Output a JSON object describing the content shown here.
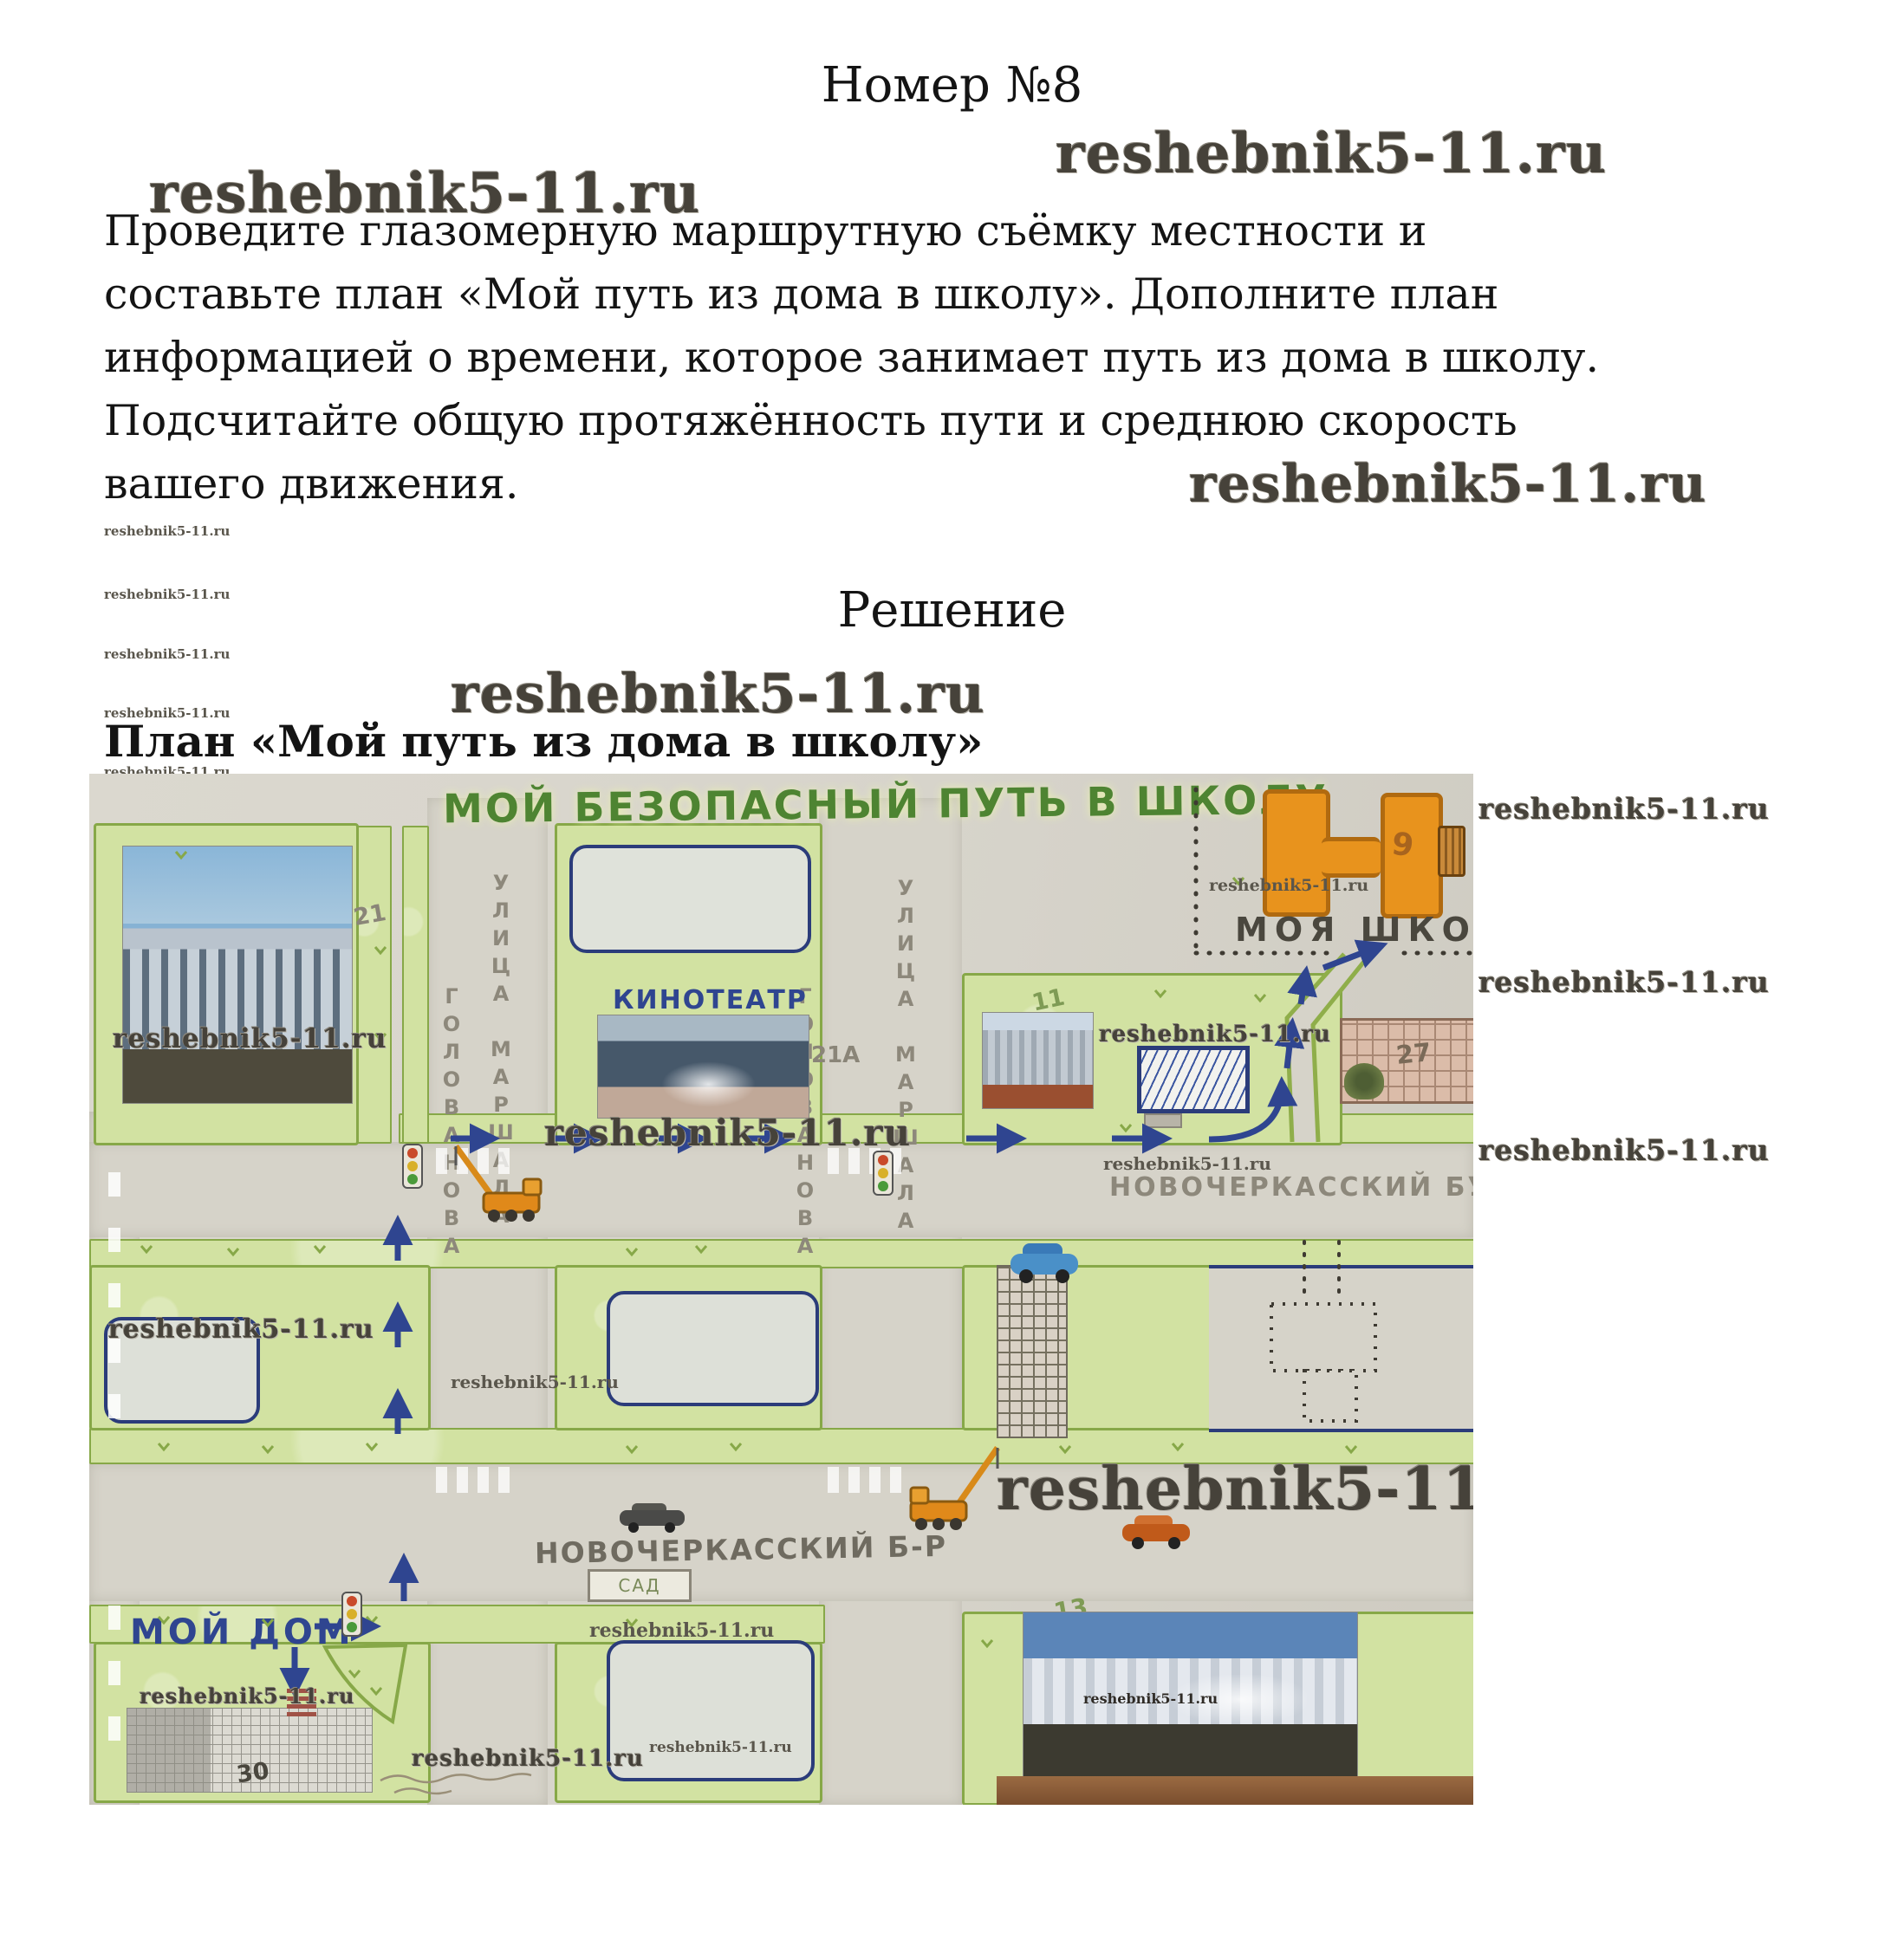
{
  "page": {
    "title": "Номер №8",
    "task_lines": [
      "Проведите глазомерную маршрутную съёмку местности и",
      "составьте план «Мой путь из дома в школу». Дополните план",
      "информацией о времени, которое занимает путь из дома в школу.",
      "Подсчитайте общую протяжённость пути и среднюю скорость",
      "вашего движения."
    ],
    "solution_heading": "Решение",
    "plan_heading": "План «Мой путь из дома в школу»"
  },
  "watermark": {
    "text": "reshebnik5-11.ru"
  },
  "map": {
    "title": "МОЙ БЕЗОПАСНЫЙ ПУТЬ В ШКОЛУ",
    "labels": {
      "street_v1_part1": "УЛИЦА МАРШАЛА",
      "street_v1_part2": "ГОЛОВАНОВА",
      "street_v2_part1": "УЛИЦА МАРШАЛА",
      "street_v2_part2": "ГОЛОВАНОВА",
      "boulevard_right": "НОВОЧЕРКАССКИЙ БУЛЬВАР",
      "boulevard_bottom": "НОВОЧЕРКАССКИЙ Б-Р",
      "cinema": "КИНОТЕАТР",
      "my_school": "МОЯ ШКОЛА",
      "my_home": "МОЙ ДОМ",
      "garden": "САД"
    },
    "house_numbers": {
      "n21": "21",
      "n21a": "21А",
      "n11": "11",
      "n27": "27",
      "n9": "9",
      "n30": "30",
      "n13": "13"
    },
    "colors": {
      "route_blue": "#2f4590",
      "school_orange": "#e8931d",
      "block_green": "#d2e2a2",
      "title_green": "#4e8432"
    }
  }
}
